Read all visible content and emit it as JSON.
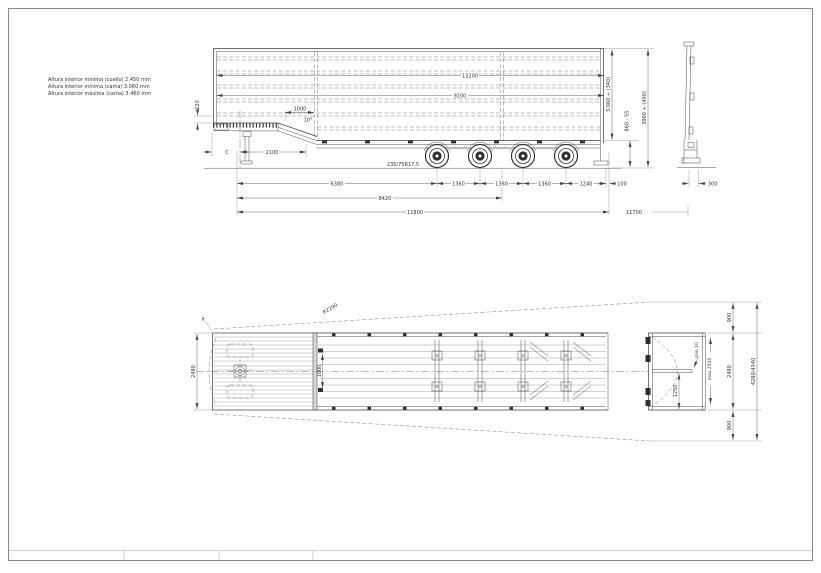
{
  "notes": {
    "line1": "Altura interior mínima (cuello) 2.450 mm",
    "line2": "Altura interior mínima (cama) 3.060 mm",
    "line3": "Altura interior máxima (cama) 3.460 mm"
  },
  "side_view": {
    "inner_length_top": "13200",
    "inner_length": "9200",
    "front_step_height": "220",
    "neck_rise": "1000",
    "neck_angle": "10°",
    "kingpin_label": "C",
    "neck_length": "2100",
    "tyre_size": "235/75R17.5",
    "interior_height": "3.060 + (340)",
    "floor_height": "860 - 55",
    "overall_height": "3960 + (400)",
    "kingpin_to_first_axle": "6380",
    "axle_spacing": "1360",
    "rear_overhang": "1240",
    "rear_offset": "100",
    "kingpin_to_last_axle": "8420",
    "overall_length": "11800",
    "body_length": "11700"
  },
  "rear_profile_view": {
    "frame_depth": "300"
  },
  "plan_view": {
    "body_width": "2480",
    "swing_radius": "R2290",
    "corner_note": "8",
    "crossmember_spacing": "1000"
  },
  "rear_plan_view": {
    "side_clearance": "900",
    "body_width": "2480",
    "overall_swept_width": "4280/4340",
    "half_width": "1250",
    "door_gap": "min 10",
    "door_swing": "max 2510"
  }
}
